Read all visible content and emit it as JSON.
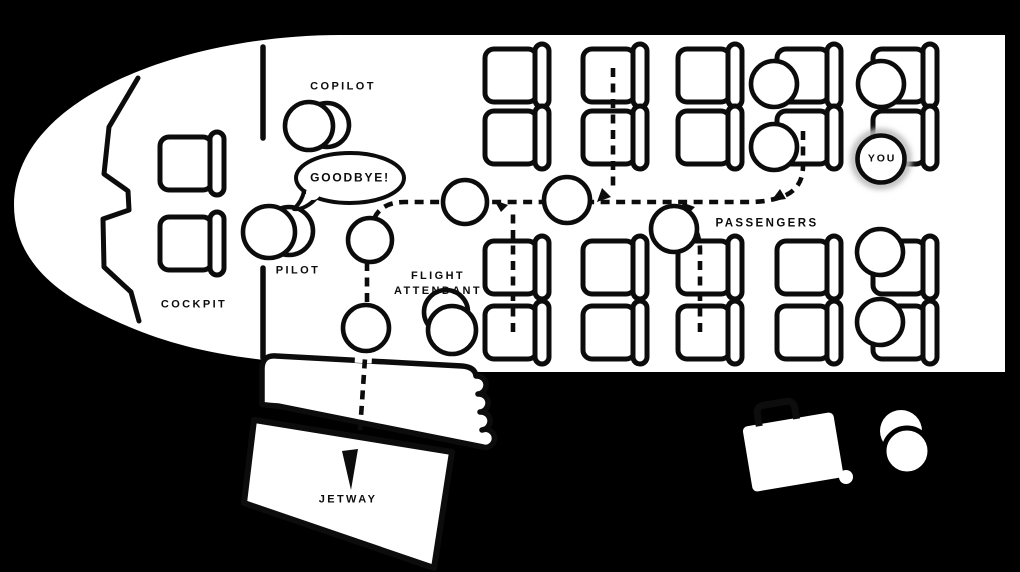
{
  "colors": {
    "background": "#000000",
    "cabin_fill": "#ffffff",
    "line": "#0c0c0c",
    "you_glow": "#bdbdbd"
  },
  "labels": {
    "cockpit": "COCKPIT",
    "pilot": "PILOT",
    "copilot": "COPILOT",
    "flight_attendant": "FLIGHT\nATTENDANT",
    "passengers": "PASSENGERS",
    "you": "YOU",
    "jetway": "JETWAY"
  },
  "speech_bubble": {
    "speaker": "pilot",
    "text": "GOODBYE!"
  },
  "icons": [
    {
      "name": "airplane-cabin-top-view-icon"
    },
    {
      "name": "cockpit-windshield-icon"
    },
    {
      "name": "seat-icon"
    },
    {
      "name": "person-circle-icon"
    },
    {
      "name": "dashed-deplaning-path"
    },
    {
      "name": "merge-arrow-icon"
    },
    {
      "name": "jetway-exit-arrow-icon"
    },
    {
      "name": "jetway-accordion-icon"
    },
    {
      "name": "suitcase-icon"
    },
    {
      "name": "walking-person-icon"
    }
  ],
  "seating": {
    "cockpit_seats": 2,
    "cabin_seat_columns": 5,
    "cabin_seat_rows": 4,
    "seated_passengers": 6,
    "walking_passengers": 5
  }
}
